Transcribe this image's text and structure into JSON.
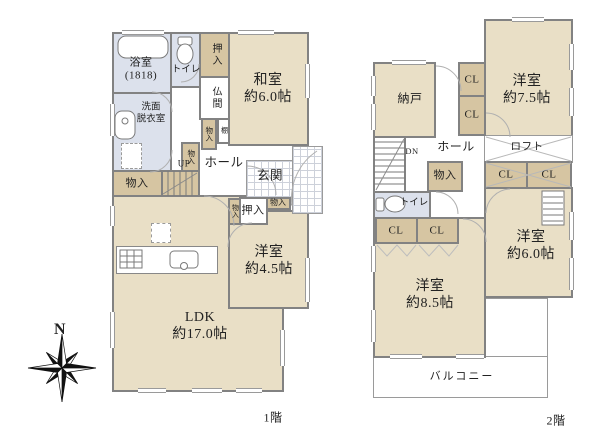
{
  "palette": {
    "room_fill": "#e9dfc6",
    "closet_fill": "#d6c5a2",
    "wet_fill": "#dce1ec",
    "wall": "#828282",
    "line": "#9a9a9a",
    "text": "#222222"
  },
  "compass": {
    "north": "N"
  },
  "f1": {
    "floor_label": "1階",
    "bathroom": "浴室\n(1818)",
    "toilet": "トイレ",
    "closet_top": "押入",
    "washitsu": "和室\n約6.0帖",
    "butsuma": "仏間",
    "washroom": "洗面\n脱衣室",
    "storage_mid": "物入",
    "shelf": "棚",
    "storage_wash": "物入",
    "up": "UP",
    "hall": "ホール",
    "genkan": "玄関",
    "storage_left": "物入",
    "storage_tiny": "物入",
    "oshiire": "押入",
    "storage_right": "物入",
    "yoshitsu45": "洋室\n約4.5帖",
    "ldk": "LDK\n約17.0帖"
  },
  "f2": {
    "floor_label": "2階",
    "nando": "納戸",
    "cl": "CL",
    "yoshitsu75": "洋室\n約7.5帖",
    "dn": "DN",
    "hall": "ホール",
    "loft": "ロフト",
    "storage": "物入",
    "toilet": "トイレ",
    "yoshitsu60": "洋室\n約6.0帖",
    "yoshitsu85": "洋室\n約8.5帖",
    "balcony": "バルコニー"
  }
}
